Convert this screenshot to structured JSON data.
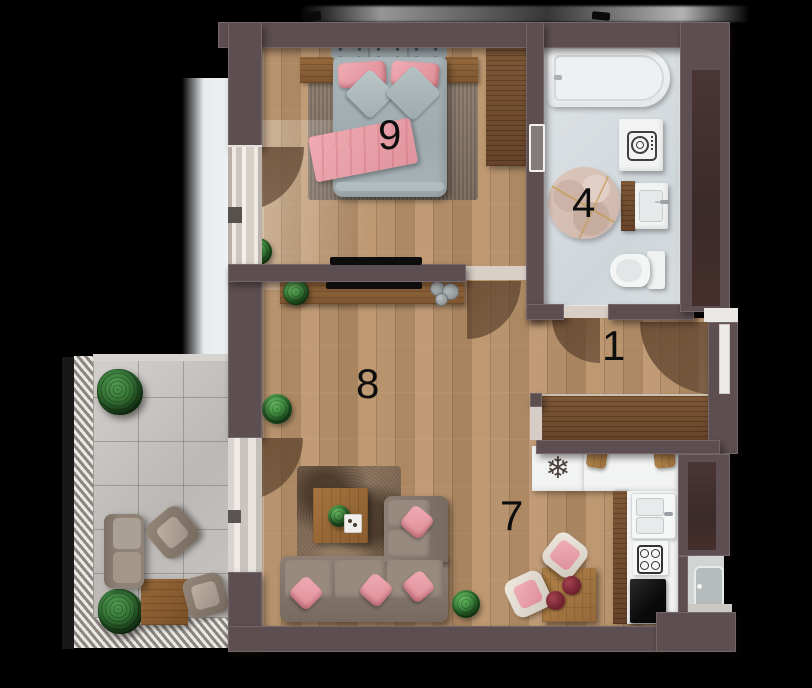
{
  "title": "apartment-floor-plan",
  "rooms": [
    {
      "key": "bedroom",
      "label": "9"
    },
    {
      "key": "bathroom",
      "label": "4"
    },
    {
      "key": "hallway",
      "label": "1"
    },
    {
      "key": "living-room",
      "label": "8"
    },
    {
      "key": "lounge-dining",
      "label": "7"
    }
  ],
  "icons": {
    "snowflake": "❄"
  },
  "palette": {
    "background": "#000000",
    "wall": "#5d4f51",
    "wall_shaft_panel": "#43302e",
    "wood_floor": "#b5926c",
    "balcony_tile": "#c9c6c3",
    "bathroom_floor": "#d9dee1",
    "accent_pink": "#e89ba3",
    "sofa_taupe": "#8d7f73",
    "plant_green": "#3f8f3f",
    "furniture_wood": "#7e5836",
    "label_color": "#0e0e0e"
  }
}
